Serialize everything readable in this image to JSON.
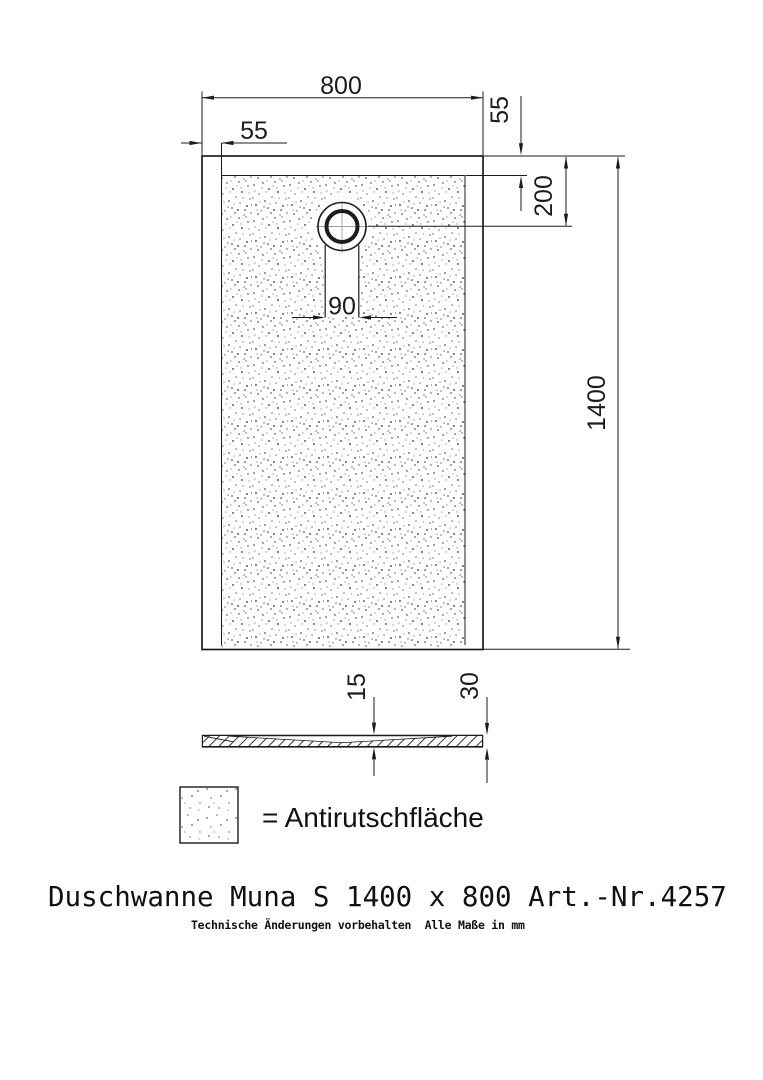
{
  "page": {
    "background": "#ffffff",
    "line_color": "#1c1c1c",
    "crosshair_color": "#a0a0a0"
  },
  "plan_view": {
    "dim_width": "800",
    "dim_inset_left": "55",
    "dim_inset_top": "55",
    "dim_drain_center_from_top": "200",
    "dim_drain_slot_width": "90",
    "dim_length": "1400"
  },
  "section_view": {
    "dim_floor_thickness": "15",
    "dim_edge_height": "30"
  },
  "legend": {
    "label": "= Antirutschfläche"
  },
  "title_block": {
    "title": "Duschwanne Muna S 1400 x 800 Art.-Nr.4257",
    "note": "Technische Änderungen vorbehalten  Alle Maße in mm"
  }
}
